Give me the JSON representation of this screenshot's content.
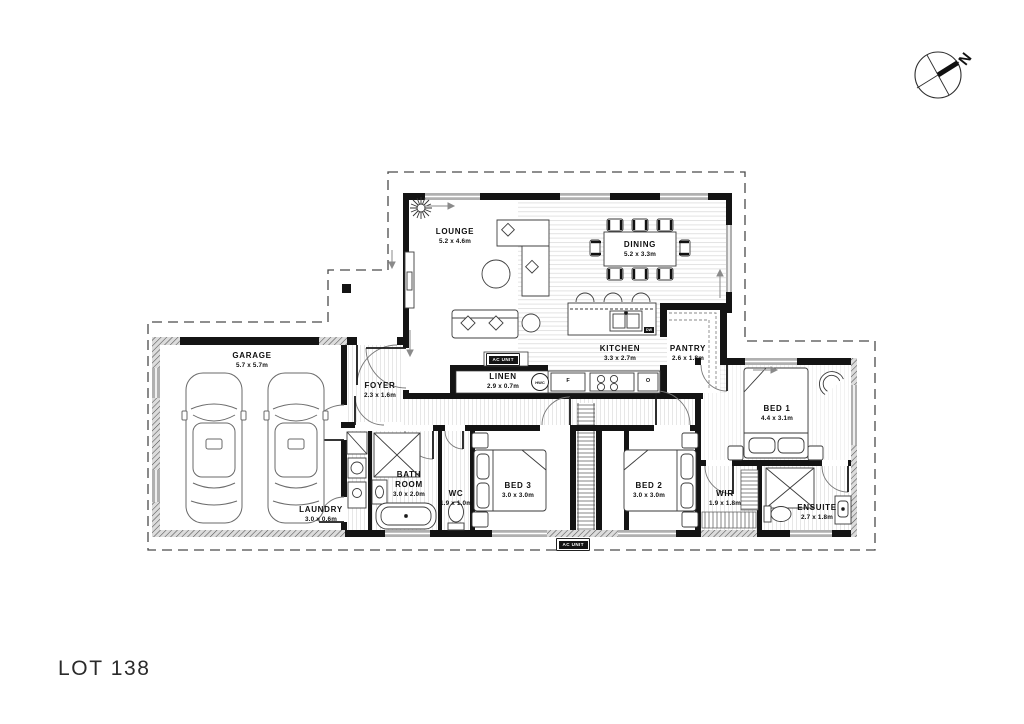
{
  "lot_title": "LOT 138",
  "compass": {
    "north_label": "N"
  },
  "rooms": {
    "garage": {
      "name": "GARAGE",
      "dims": "5.7 x 5.7m"
    },
    "lounge": {
      "name": "LOUNGE",
      "dims": "5.2 x 4.6m"
    },
    "dining": {
      "name": "DINING",
      "dims": "5.2 x 3.3m"
    },
    "kitchen": {
      "name": "KITCHEN",
      "dims": "3.3 x 2.7m"
    },
    "pantry": {
      "name": "PANTRY",
      "dims": "2.6 x 1.8m"
    },
    "foyer": {
      "name": "FOYER",
      "dims": "2.3 x 1.6m"
    },
    "linen": {
      "name": "LINEN",
      "dims": "2.9 x 0.7m"
    },
    "laundry": {
      "name": "LAUNDRY",
      "dims": "3.0 x 0.6m"
    },
    "bathroom": {
      "name": "BATH ROOM",
      "dims": "3.0 x 2.0m"
    },
    "wc": {
      "name": "WC",
      "dims": "1.9 x 1.0m"
    },
    "bed3": {
      "name": "BED 3",
      "dims": "3.0 x 3.0m"
    },
    "bed2": {
      "name": "BED 2",
      "dims": "3.0 x 3.0m"
    },
    "bed1": {
      "name": "BED 1",
      "dims": "4.4 x 3.1m"
    },
    "wir": {
      "name": "WIR",
      "dims": "1.9 x 1.8m"
    },
    "ensuite": {
      "name": "ENSUITE",
      "dims": "2.7 x 1.8m"
    }
  },
  "fixtures": {
    "ac_unit": "AC UNIT",
    "hwc": "HWC",
    "fridge": "F",
    "oven": "O",
    "dishwasher": "DW"
  },
  "colors": {
    "wall": "#141414",
    "window": "#b0b0b0",
    "boundary_dash": "#4a4a4a",
    "background": "#ffffff"
  }
}
